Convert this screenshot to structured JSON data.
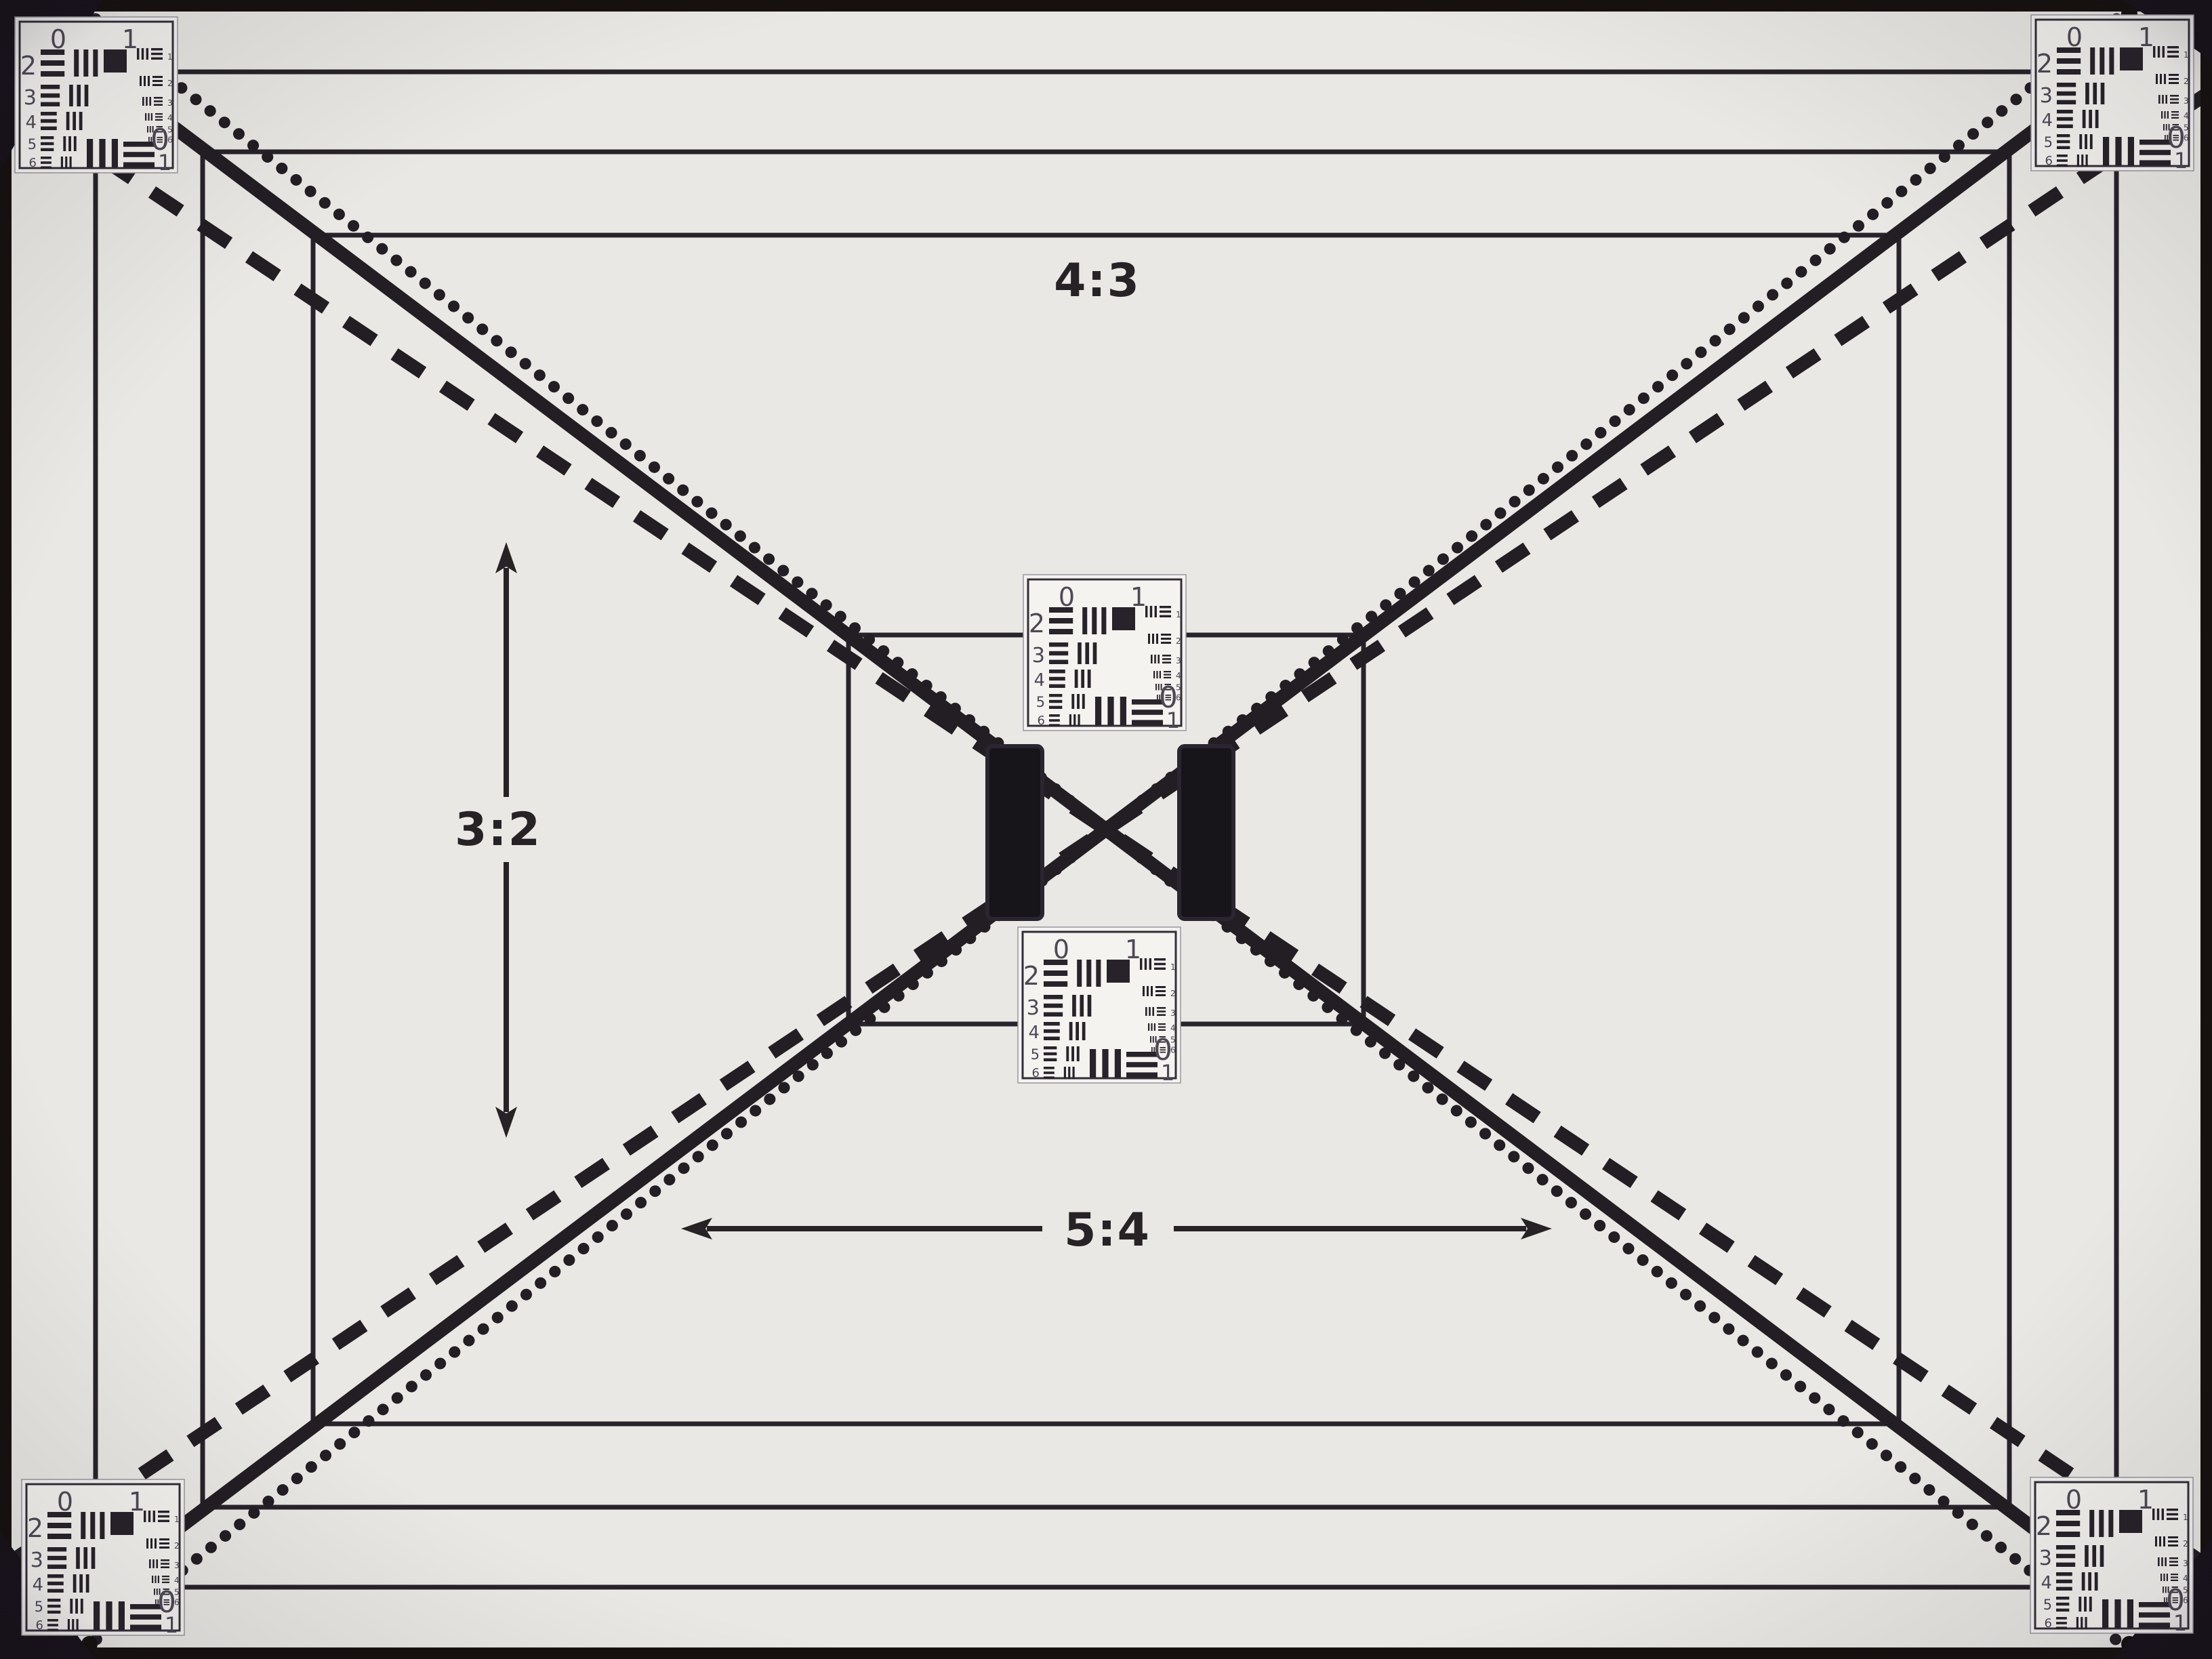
{
  "labels": {
    "aspect_top": "4:3",
    "aspect_left": "3:2",
    "aspect_bottom": "5:4"
  },
  "card": {
    "top_scale": [
      "0",
      "1"
    ],
    "row_numbers": [
      "2",
      "3",
      "4",
      "5",
      "6"
    ],
    "element_numbers": [
      "1",
      "2",
      "3",
      "4",
      "5",
      "6"
    ],
    "bottom_scale": [
      "0",
      "1"
    ]
  },
  "cards": [
    {
      "position": "top-left"
    },
    {
      "position": "top-right"
    },
    {
      "position": "bottom-left"
    },
    {
      "position": "bottom-right"
    },
    {
      "position": "center-top"
    },
    {
      "position": "center-bottom"
    }
  ],
  "colors": {
    "paper": "#e9e8e4",
    "ink": "#28222a",
    "line_black": "#231d24",
    "card_background": "#f4f3ef",
    "border_black": "#16110f",
    "numeral_gray": "#4e4856"
  }
}
